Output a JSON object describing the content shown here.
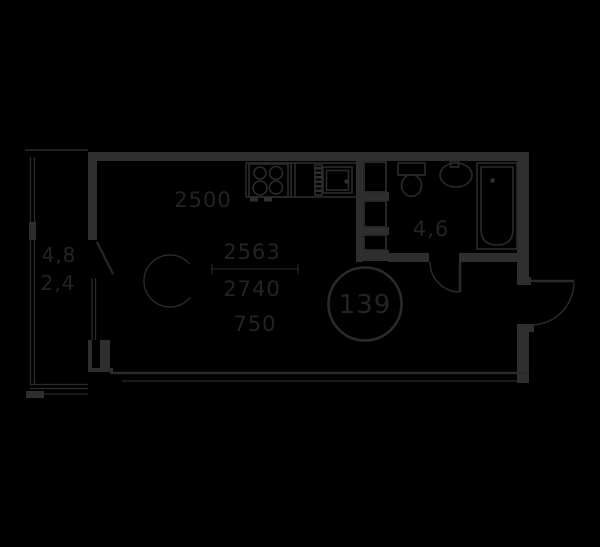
{
  "canvas": {
    "width": 600,
    "height": 547,
    "background_color": "#000000",
    "line_color": "#2e2e2e",
    "thin_line_color": "#2a2a2a",
    "text_color": "#232323"
  },
  "labels": {
    "kitchen_dimension": "2500",
    "room_dimension_top": "2563",
    "room_dimension_middle": "2740",
    "table_dimension": "750",
    "bathroom_area": "4,6",
    "balcony_area": "4,8",
    "balcony_area_reduced": "2,4",
    "unit_number": "139"
  },
  "fixtures": [
    "stove-icon",
    "kitchen-sink-icon",
    "dish-rack-icon",
    "duct-shaft-icon",
    "toilet-icon",
    "washbasin-icon",
    "bathtub-icon",
    "dining-table-icon",
    "balcony-door-icon",
    "bathroom-door-swing-icon",
    "entry-door-swing-icon",
    "unit-number-circle",
    "window-glazing",
    "dimension-line"
  ]
}
